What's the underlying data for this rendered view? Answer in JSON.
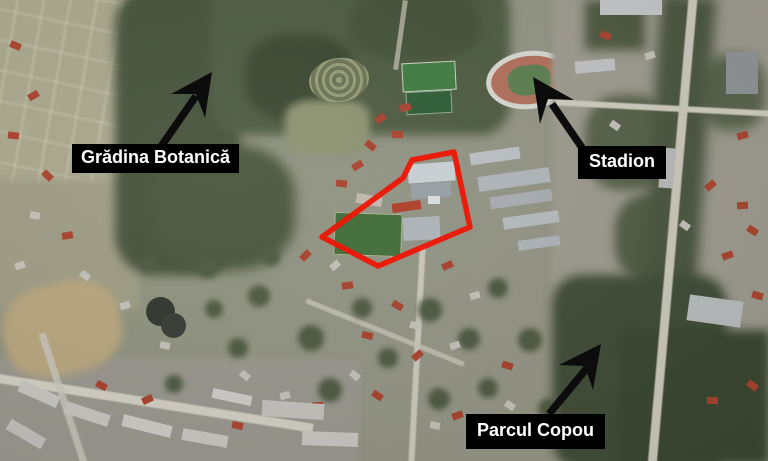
{
  "map": {
    "type": "satellite-aerial-map",
    "annotations": [
      {
        "id": "gradina-botanica",
        "label": "Grădina Botanică"
      },
      {
        "id": "stadion",
        "label": "Stadion"
      },
      {
        "id": "parcul-copou",
        "label": "Parcul Copou"
      }
    ],
    "highlight": {
      "name": "highlighted-area",
      "outline_color": "#ee1606"
    },
    "arrow_color": "#0c0c0c",
    "colors": {
      "label_background": "#000000",
      "label_text": "#ffffff",
      "forest_green": "#46533b",
      "field_tan": "#a9a68c",
      "urban_gray": "#9d9a8e",
      "stadium_track": "#b1705b",
      "pitch_green": "#3f7c41"
    }
  }
}
